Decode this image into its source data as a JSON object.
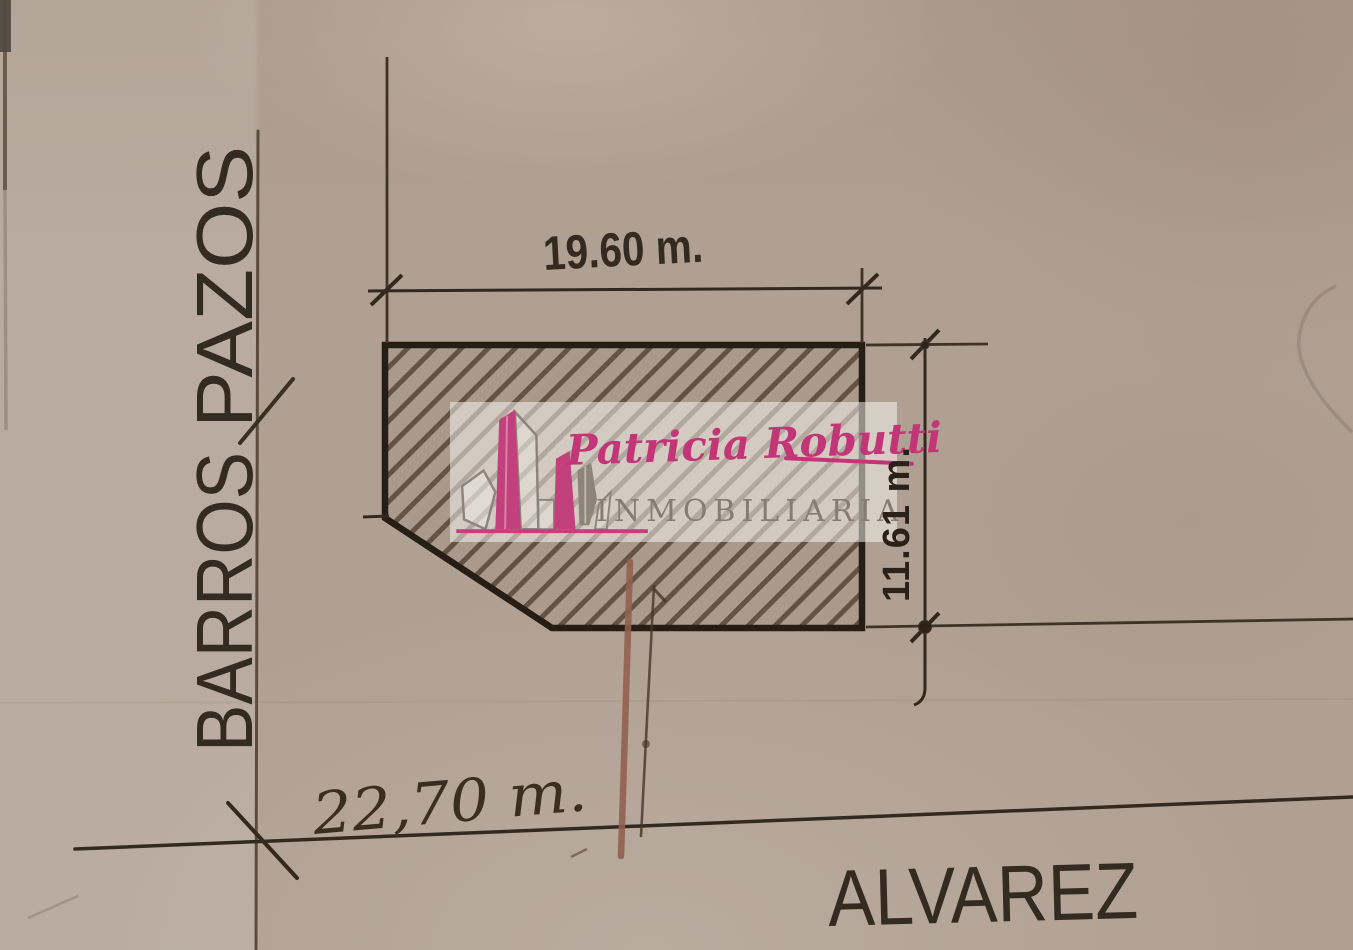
{
  "page": {
    "description": "Scanned hand-drawn land plot survey sketch (corner parcel) with real-estate agency watermark"
  },
  "labels": {
    "street_left_upper_word": "PAZOS",
    "street_left_lower_word": "BARROS",
    "street_bottom": "ALVAREZ",
    "dim_top": "19.60 m.",
    "dim_right": "11.61 m.",
    "dim_bottom_left": "22,70 m."
  },
  "plot": {
    "frontage_m": 19.6,
    "depth_m": 11.61,
    "corner_distance_m": 22.7,
    "streets": [
      "BARROS PAZOS",
      "ALVAREZ"
    ]
  },
  "watermark": {
    "name": "Patricia Robutti",
    "subtitle": "INMOBILIARIA",
    "accent_color": "#c23677",
    "subtitle_color": "#867c73"
  },
  "colors": {
    "paper": "#b0a093",
    "ink_dark": "#2a211a",
    "ink_mid": "#45382c",
    "hatch": "#4a382a",
    "pen_red": "#91604c",
    "band": "rgba(250,247,242,0.52)"
  }
}
